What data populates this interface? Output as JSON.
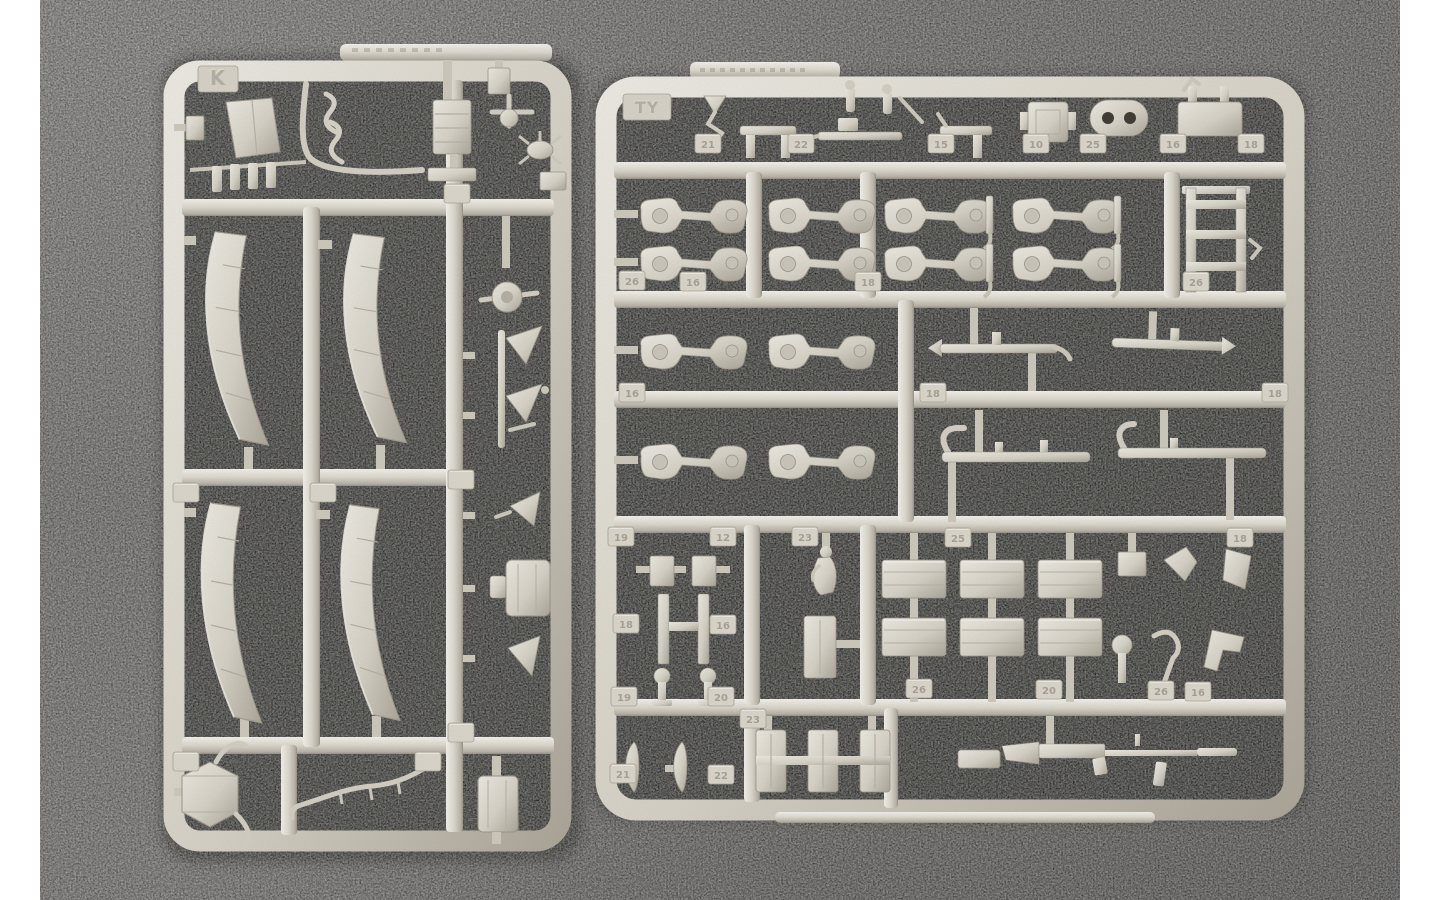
{
  "scene": {
    "type": "photograph",
    "subject": "Two sand-grey injection-moulded model kit sprues (runners) full of unassembled plastic parts, lying on a dark speckled grey mat, with white borders at the left and right edges of the frame",
    "border_color": "#ffffff",
    "mat_color": "#6e6c68",
    "plastic_color": "#d8d3c7",
    "shadow_color": "#201e1a"
  },
  "sprues": [
    {
      "name": "left-sprue",
      "label": "K",
      "orientation": "tall rectangle",
      "notable_parts": [
        "four curved fender / track-guard sections",
        "angled bracket plate",
        "ribbed equipment box",
        "long bent control rod",
        "row of small mounting posts",
        "round hub with pin",
        "zig-zag bracket cluster",
        "hexagonal housing with arms",
        "thin curved tow rod",
        "small rounded stowage box"
      ]
    },
    {
      "name": "right-sprue",
      "label": "TY",
      "orientation": "large square",
      "notable_parts": [
        "eight suspension swing-arms",
        "two torsion-bar axle rods",
        "two tow-bar rails",
        "six ribbed stowage boxes",
        "ladder frame",
        "pill-shaped plate with two holes",
        "machine gun",
        "three ribbed brackets on a bar",
        "assorted pins, hooks and clips"
      ],
      "tabs": [
        "21",
        "22",
        "15",
        "10",
        "25",
        "16",
        "18",
        "26",
        "16",
        "18",
        "26",
        "16",
        "18",
        "18",
        "19",
        "12",
        "23",
        "25",
        "18",
        "18",
        "16",
        "19",
        "20",
        "26",
        "20",
        "26",
        "16",
        "21",
        "22",
        "23"
      ]
    }
  ]
}
